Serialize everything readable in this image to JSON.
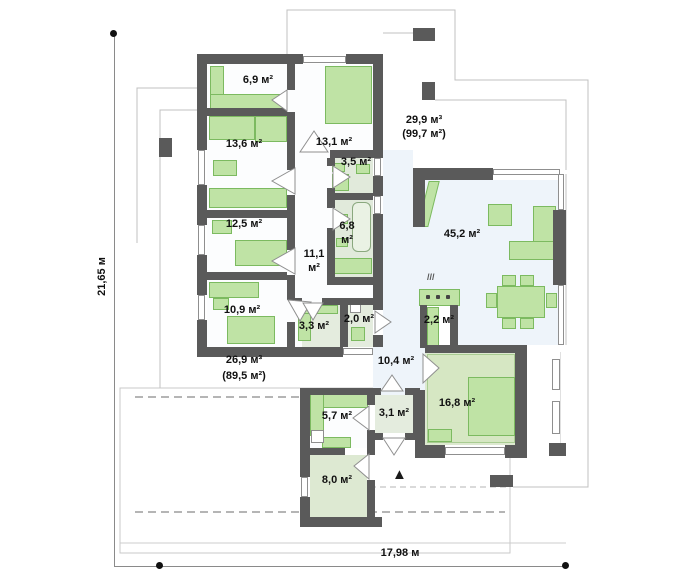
{
  "plan": {
    "type": "house-floor-plan",
    "rooms": {
      "wardrobe_69": "6,9 м²",
      "bedroom_136": "13,6 м²",
      "bedroom_131": "13,1 м²",
      "bath_35": "3,5 м²",
      "bedroom_125": "12,5 м²",
      "bath_68_l1": "6,8",
      "bath_68_l2": "м²",
      "corridor_111_l1": "11,1",
      "corridor_111_l2": "м²",
      "bedroom_109": "10,9 м²",
      "storage_33": "3,3 м²",
      "wc_20": "2,0 м²",
      "living_452": "45,2 м²",
      "pantry_22": "2,2 м²",
      "hall_104": "10,4 м²",
      "garage_168": "16,8 м²",
      "laundry_57": "5,7 м²",
      "vestibule_31": "3,1 м²",
      "boiler_80": "8,0 м²"
    },
    "terraces": {
      "top_l1": "29,9 м³",
      "top_l2": "(99,7 м²)",
      "left_l1": "26,9 м³",
      "left_l2": "(89,5 м²)"
    },
    "dimensions": {
      "height": "21,65 м",
      "width": "17,98 м"
    },
    "icons": {
      "entrance_arrow": "▲",
      "cooktop_steam": "///"
    },
    "colors": {
      "wall": "#5a5a5a",
      "furniture": "#bfe3a5",
      "furniture_border": "#7cba60",
      "floor_white": "#fcfdfe",
      "floor_blue": "#eef4fa",
      "floor_bath": "#e1eadb",
      "floor_green": "#dde9d0",
      "thin_line": "#c0c0c0",
      "text": "#111111"
    }
  }
}
